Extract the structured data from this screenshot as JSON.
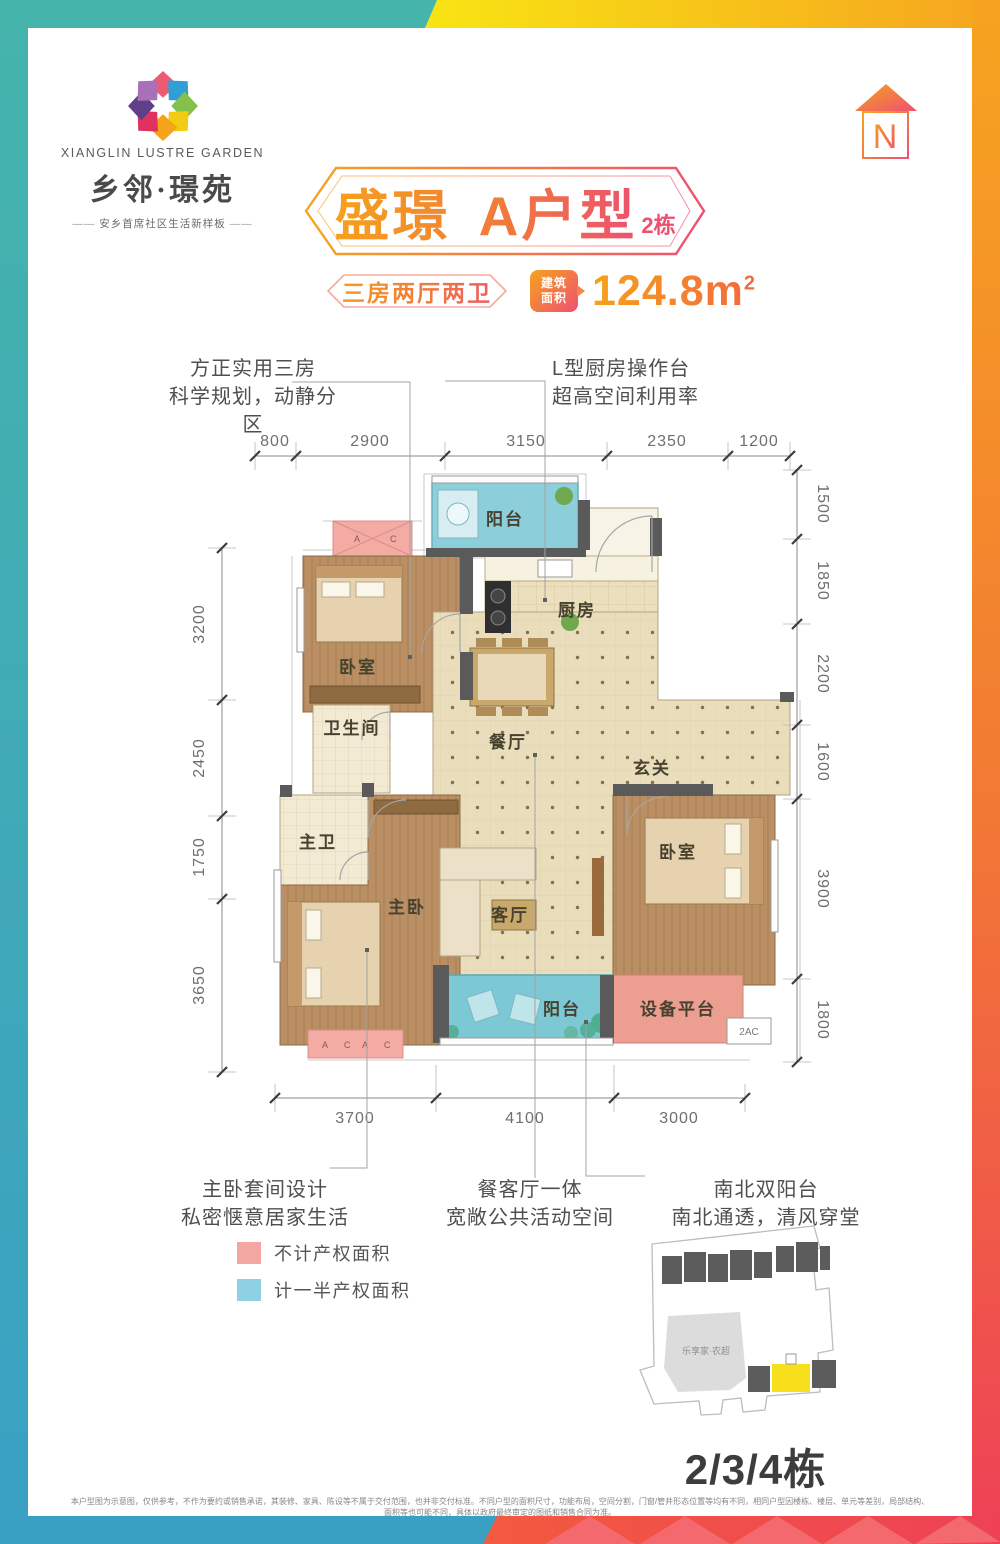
{
  "brand": {
    "name_en": "XIANGLIN  LUSTRE GARDEN",
    "name_cn": "乡邻·璟苑",
    "tagline": "安乡首席社区生活新样板",
    "dash": "——"
  },
  "north": {
    "label": "N"
  },
  "header": {
    "title": "盛璟 A户型",
    "building_tag": "2栋",
    "layout_spec": "三房两厅两卫",
    "area_badge": [
      "建筑",
      "面积"
    ],
    "area_value": "124.8m",
    "area_sup": "2"
  },
  "callouts": {
    "top_left": [
      "方正实用三房",
      "科学规划，动静分区"
    ],
    "top_right": [
      "L型厨房操作台",
      "超高空间利用率"
    ],
    "bottom_left": [
      "主卧套间设计",
      "私密惬意居家生活"
    ],
    "bottom_center": [
      "餐客厅一体",
      "宽敞公共活动空间"
    ],
    "bottom_right": [
      "南北双阳台",
      "南北通透，清风穿堂"
    ]
  },
  "dimensions": {
    "top": [
      "800",
      "2900",
      "3150",
      "2350",
      "1200"
    ],
    "left": [
      "3200",
      "2450",
      "1750",
      "3650"
    ],
    "right": [
      "1500",
      "1850",
      "2200",
      "1600",
      "3900",
      "1800"
    ],
    "bottom": [
      "3700",
      "4100",
      "3000"
    ]
  },
  "rooms": {
    "balcony_top": "阳台",
    "bedroom_top": "卧室",
    "kitchen": "厨房",
    "dining": "餐厅",
    "entry": "玄关",
    "bathroom": "卫生间",
    "master_bath": "主卫",
    "master_bedroom": "主卧",
    "living": "客厅",
    "bedroom_right": "卧室",
    "balcony_bottom": "阳台",
    "equipment": "设备平台",
    "ac_a": "A",
    "ac_c": "C",
    "ac_2": "2AC"
  },
  "legend": {
    "items": [
      {
        "label": "不计产权面积",
        "color": "#f2a7a2"
      },
      {
        "label": "计一半产权面积",
        "color": "#8fd0e5"
      }
    ]
  },
  "site_map": {
    "market_label": "乐享家·农超",
    "caption": "2/3/4栋"
  },
  "footer": {
    "disclaimer": "本户型图为示意图，仅供参考，不作为要约或销售承诺，其装修、家具、陈设等不属于交付范围，也并非交付标准。不同户型的面积尺寸，功能布局，空间分割，门窗/管井形态位置等均有不同，相同户型因楼栋、楼层、单元等差别，局部结构、面积等也可能不同，具体以政府最终审定的图纸和销售合同为准。"
  },
  "colors": {
    "teal": "#45b4ab",
    "cyan": "#3aa0c4",
    "yellow": "#f6e316",
    "orange": "#f6a41f",
    "red": "#ee4157",
    "accent_pink": "#ee5170",
    "nonproperty_pink": "#f2a7a2",
    "half_property_blue": "#8fd0e5"
  }
}
